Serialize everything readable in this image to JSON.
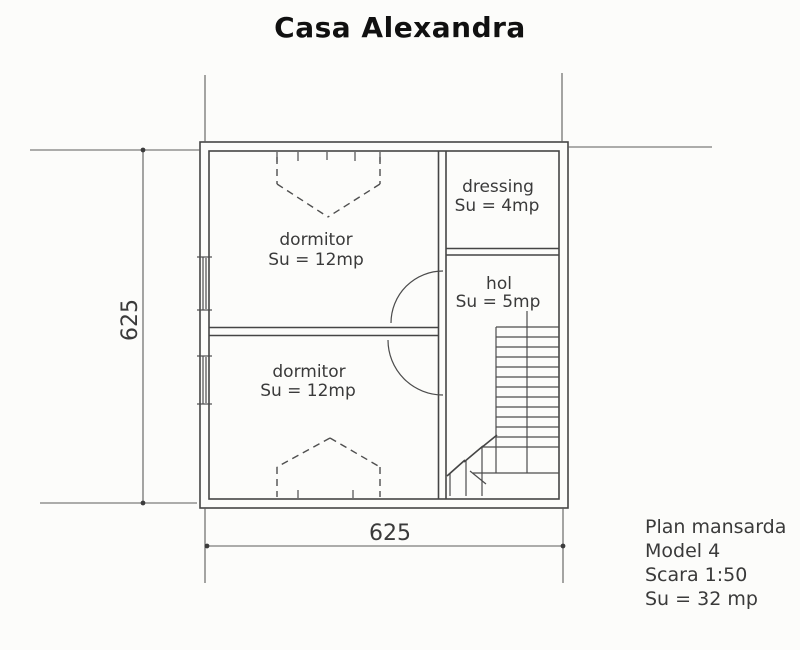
{
  "title": "Casa Alexandra",
  "rooms": [
    {
      "name": "dormitor",
      "area": "Su = 12mp"
    },
    {
      "name": "dressing",
      "area": "Su = 4mp"
    },
    {
      "name": "hol",
      "area": "Su = 5mp"
    },
    {
      "name": "dormitor",
      "area": "Su = 12mp"
    }
  ],
  "dimensions": {
    "left": "625",
    "bottom": "625"
  },
  "legend": {
    "plan_name": "Plan mansarda",
    "model": "Model 4",
    "scale": "Scara 1:50",
    "total_area": "Su = 32 mp"
  },
  "colors": {
    "line": "#454545",
    "dimension_line": "#5b5b5b",
    "text": "#3a3a3a",
    "title": "#101010",
    "background": "#fcfcfa"
  }
}
